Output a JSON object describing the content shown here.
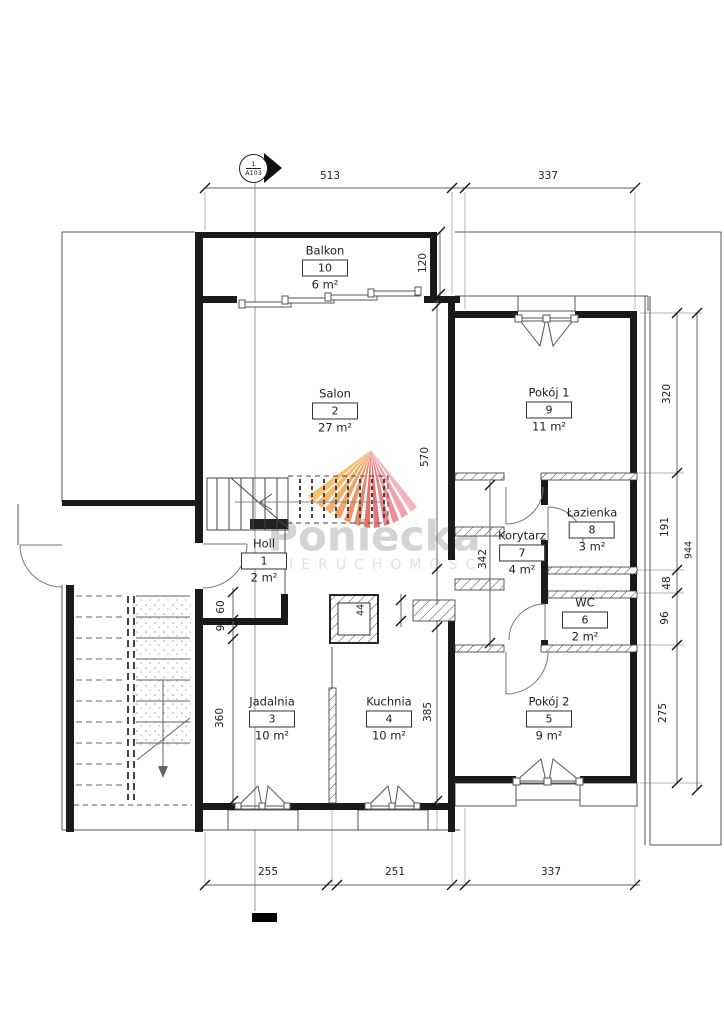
{
  "marker": {
    "number": "1",
    "sheet": "A103"
  },
  "watermark": {
    "brand": "Poniecka",
    "subtitle": "NIERUCHOMOŚCI"
  },
  "rooms": [
    {
      "name": "Holl",
      "number": "1",
      "area": "2 m²"
    },
    {
      "name": "Salon",
      "number": "2",
      "area": "27 m²"
    },
    {
      "name": "Jadalnia",
      "number": "3",
      "area": "10 m²"
    },
    {
      "name": "Kuchnia",
      "number": "4",
      "area": "10 m²"
    },
    {
      "name": "Pokój 2",
      "number": "5",
      "area": "9 m²"
    },
    {
      "name": "WC",
      "number": "6",
      "area": "2 m²"
    },
    {
      "name": "Korytarz",
      "number": "7",
      "area": "4 m²"
    },
    {
      "name": "Łazienka",
      "number": "8",
      "area": "3 m²"
    },
    {
      "name": "Pokój 1",
      "number": "9",
      "area": "11 m²"
    },
    {
      "name": "Balkon",
      "number": "10",
      "area": "6 m²"
    }
  ],
  "dimensions": {
    "top_left": "513",
    "top_right": "337",
    "balcony_depth": "120",
    "salon_length": "570",
    "corridor_length": "342",
    "room1_length": "320",
    "bathroom_length": "191",
    "duct_height": "48",
    "wc_length": "96",
    "room2_length": "275",
    "total_length": "944",
    "holl_opening": "60",
    "wall_offset": "9",
    "dining_length": "360",
    "kitchen_length": "385",
    "flue_width": "44",
    "bottom_left": "255",
    "bottom_center": "251",
    "bottom_right": "337"
  },
  "colors": {
    "wall": "#1a1a1a",
    "dim_line": "#666666",
    "watermark_text": "#d4d4d4",
    "fan_orange": "#f0953f",
    "fan_red": "#e15247",
    "fan_pink": "#f3a2a8"
  }
}
